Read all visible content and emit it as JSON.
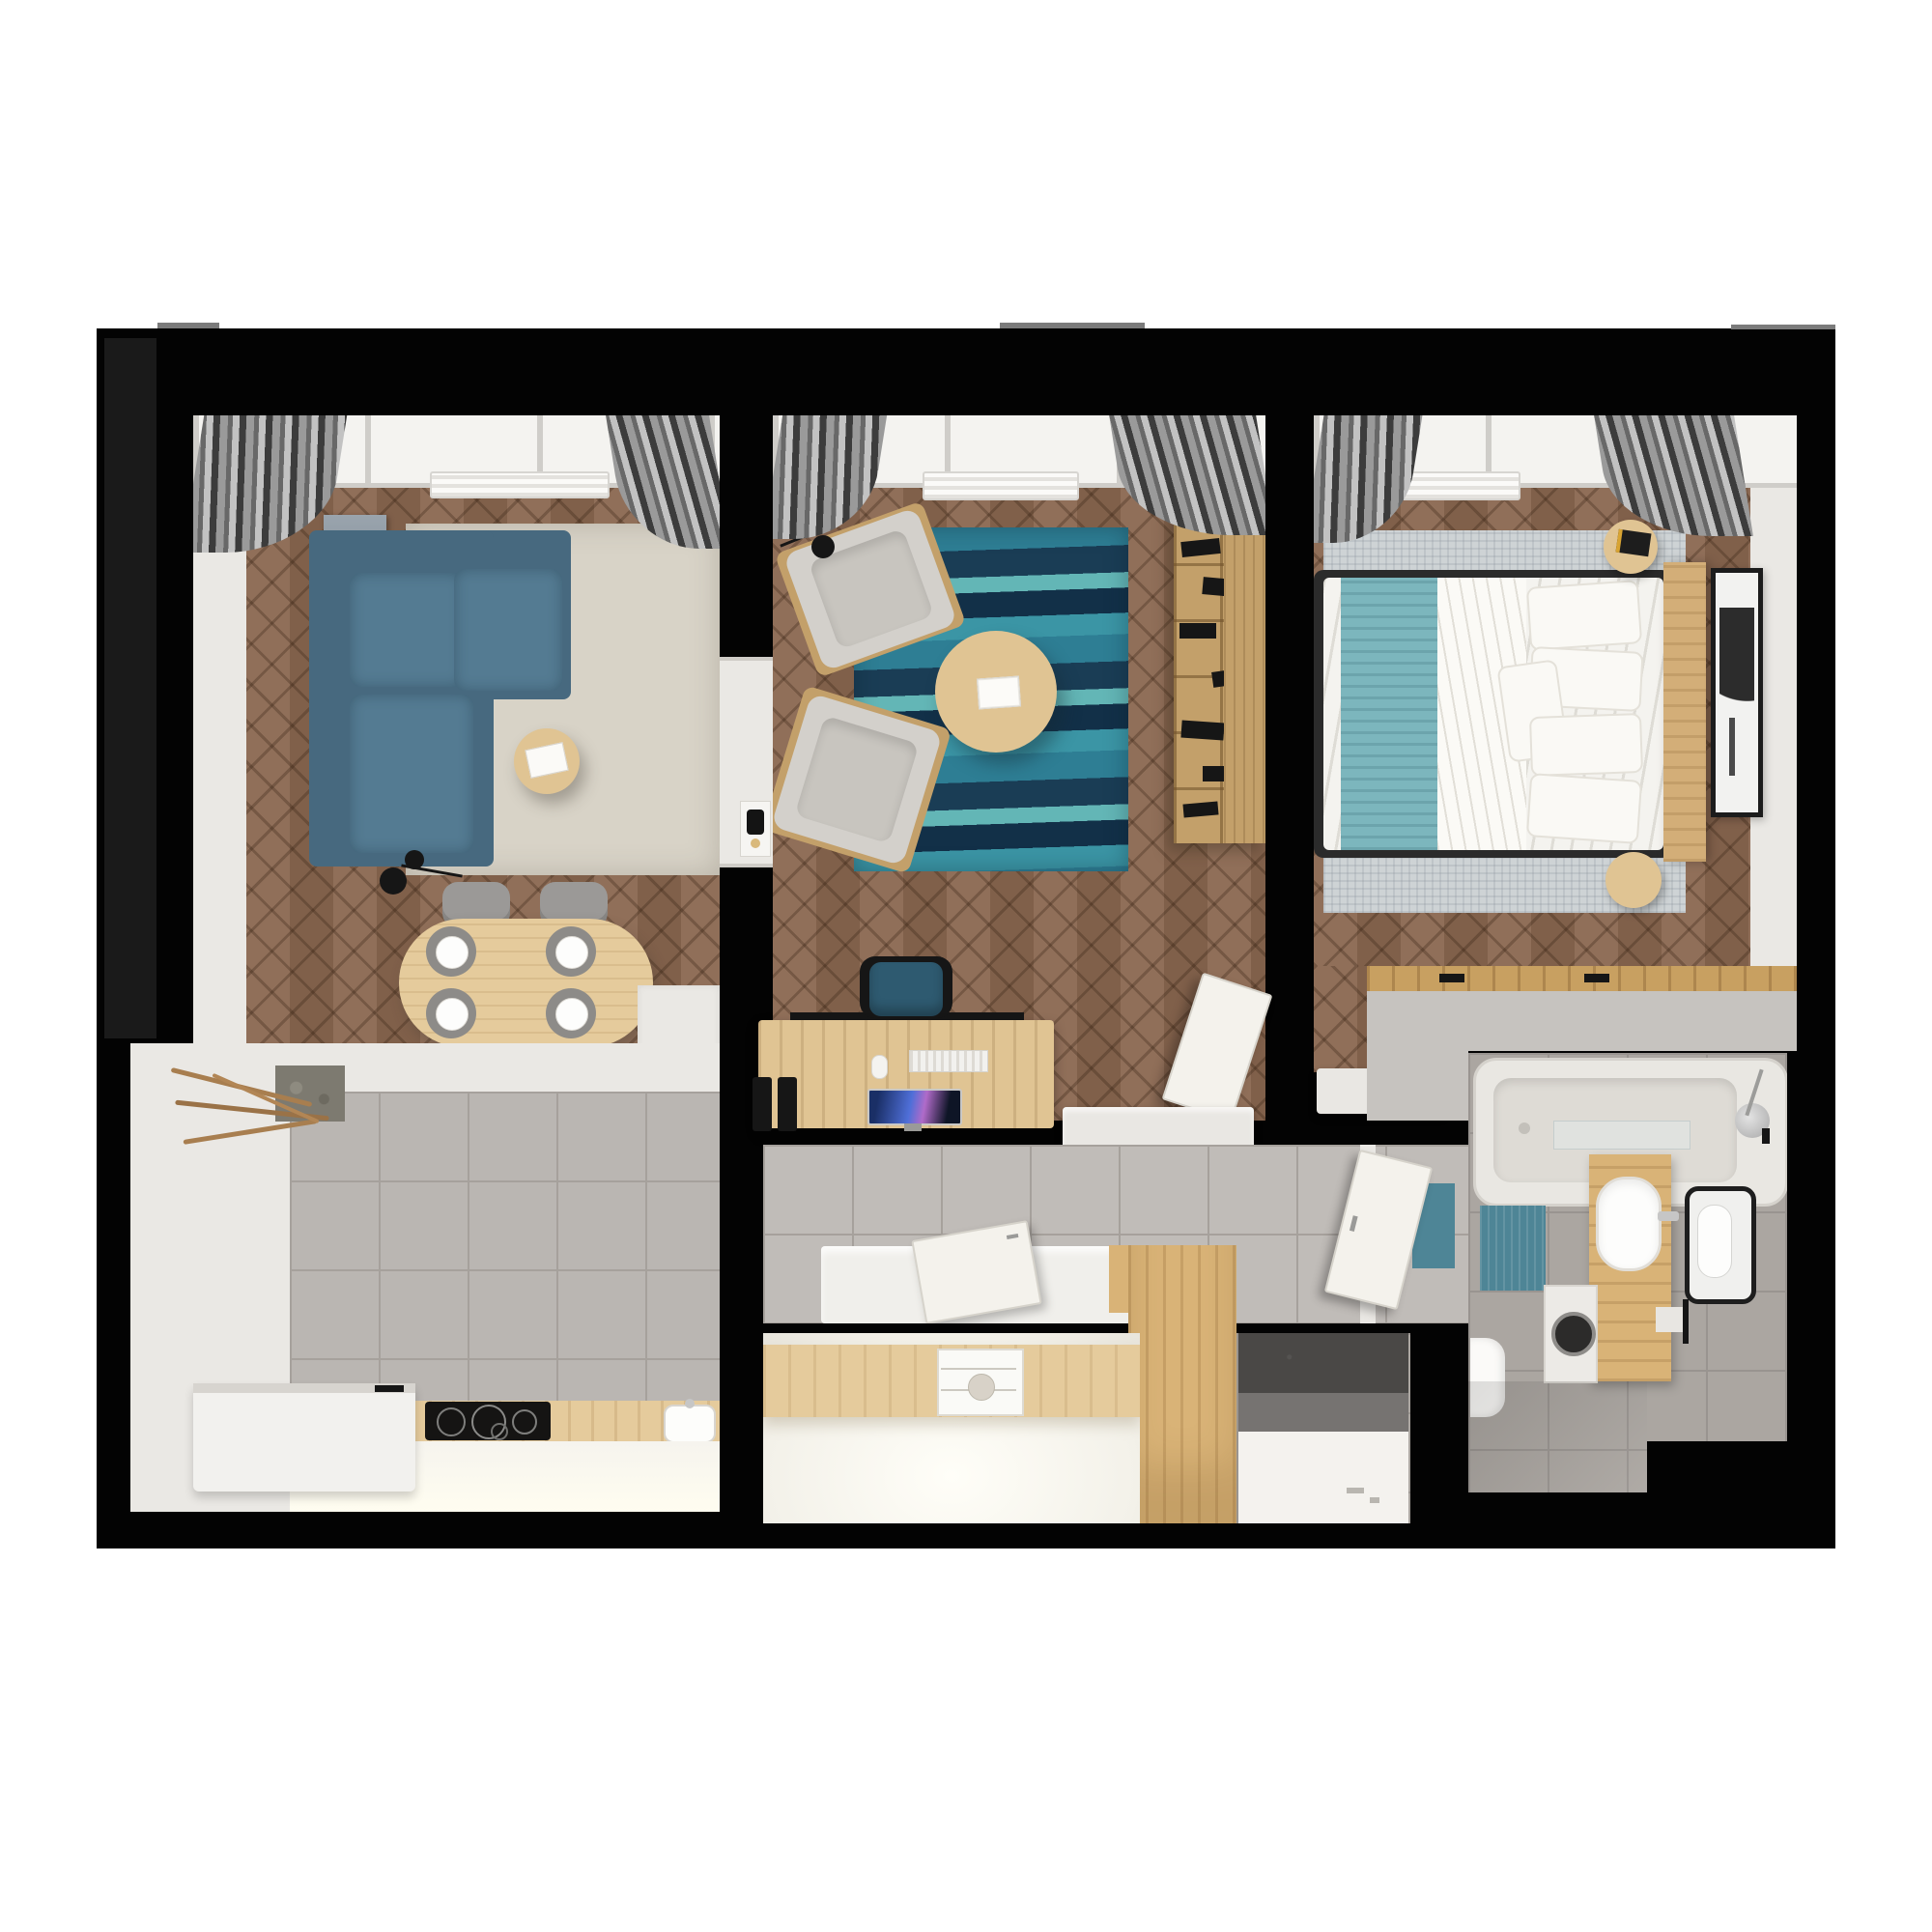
{
  "scene": {
    "type": "3d-rendered-apartment-floor-plan-top-view",
    "background": "#ffffff",
    "no_visible_text": true
  },
  "colors": {
    "wall": "#030303",
    "wall-dark-strip": "#1a1a1a",
    "white-wall": "#eae8e4",
    "window": "#f4f3f0",
    "window-frame": "#cfcdc9",
    "wood-floor": "#8a6750",
    "tile": "#bab6b2",
    "tile-line": "#a6a19c",
    "bath-tile": "#aba6a1",
    "bath-tile-line": "#999490",
    "rug-beige": "#d8d3c7",
    "rug-bedroom": "#ced3d5",
    "rug-teal-1": "#2e7e94",
    "rug-teal-2": "#1a3d55",
    "rug-teal-3": "#63b6b6",
    "rug-teal-4": "#123048",
    "rug-teal-5": "#3b95a5",
    "sofa": "#47697f",
    "sofa-light": "#547b92",
    "chair-gray": "#9b9997",
    "armchair": "#d3d0cb",
    "armchair-cushion": "#c8c5bf",
    "office-chair": "#2e5a70",
    "wood-furniture": "#e0c493",
    "wood-shelf": "#c3a06a",
    "wood-headboard": "#d3ae78",
    "wood-vanity": "#d9b377",
    "wood-counter": "#e5cb9c",
    "wood-rail": "#c8a061",
    "bed-frame": "#2b2b2b",
    "duvet": "#f4f3ef",
    "teal-blanket": "#7cb6bd",
    "teal-mat": "#4e8596",
    "dark-mat": "#4a4846",
    "cooktop": "#151413",
    "metal": "#c6c6c6",
    "branch": "#a87e4f",
    "art-navy": "#3c4d63"
  },
  "rooms": [
    {
      "id": "living-room",
      "furniture": [
        "corner-sofa",
        "beige-rug",
        "round-side-table",
        "magazines",
        "floor-lamp",
        "dining-table",
        "dining-chairs-x4",
        "place-settings-x4",
        "wall-art-canvas",
        "radiator",
        "curtains",
        "window-band",
        "tall-white-cabinet"
      ]
    },
    {
      "id": "lounge-office",
      "furniture": [
        "armchair-x2",
        "teal-striped-rug",
        "round-coffee-table",
        "open-book",
        "bookshelf-with-books",
        "desk",
        "desk-chair",
        "monitor",
        "keyboard",
        "mouse",
        "file-holders",
        "wall-sconce",
        "intercom-panel",
        "leaning-door",
        "low-radiator-cabinet",
        "radiator",
        "curtains",
        "window-band"
      ]
    },
    {
      "id": "bedroom",
      "furniture": [
        "double-bed",
        "teal-throw",
        "duvet",
        "pillows-x5",
        "wood-headboard",
        "round-nightstand-x2",
        "magazine",
        "area-rug",
        "wall-art-frame",
        "radiator",
        "curtains",
        "window-band",
        "low-radiator-cabinet",
        "wardrobe-rail"
      ]
    },
    {
      "id": "kitchen",
      "furniture": [
        "tile-floor",
        "wood-countertop",
        "induction-cooktop",
        "sink",
        "white-bench",
        "branch-decor",
        "cabinet-glow-front"
      ]
    },
    {
      "id": "hallway",
      "furniture": [
        "tile-floor",
        "white-sideboard",
        "leaning-door",
        "open-door",
        "teal-towel",
        "tall-wood-cabinet"
      ]
    },
    {
      "id": "closet",
      "furniture": [
        "wood-shelf",
        "drawer-organizer",
        "bowl"
      ]
    },
    {
      "id": "shower-room",
      "furniture": [
        "dark-mat",
        "shower-tray",
        "drain"
      ]
    },
    {
      "id": "bathroom",
      "furniture": [
        "bathtub",
        "faucet-shower",
        "teal-bath-mat",
        "glass-shelf",
        "wood-vanity",
        "oval-sink",
        "mirror",
        "washing-machine",
        "toilet",
        "towel-bar"
      ]
    }
  ]
}
